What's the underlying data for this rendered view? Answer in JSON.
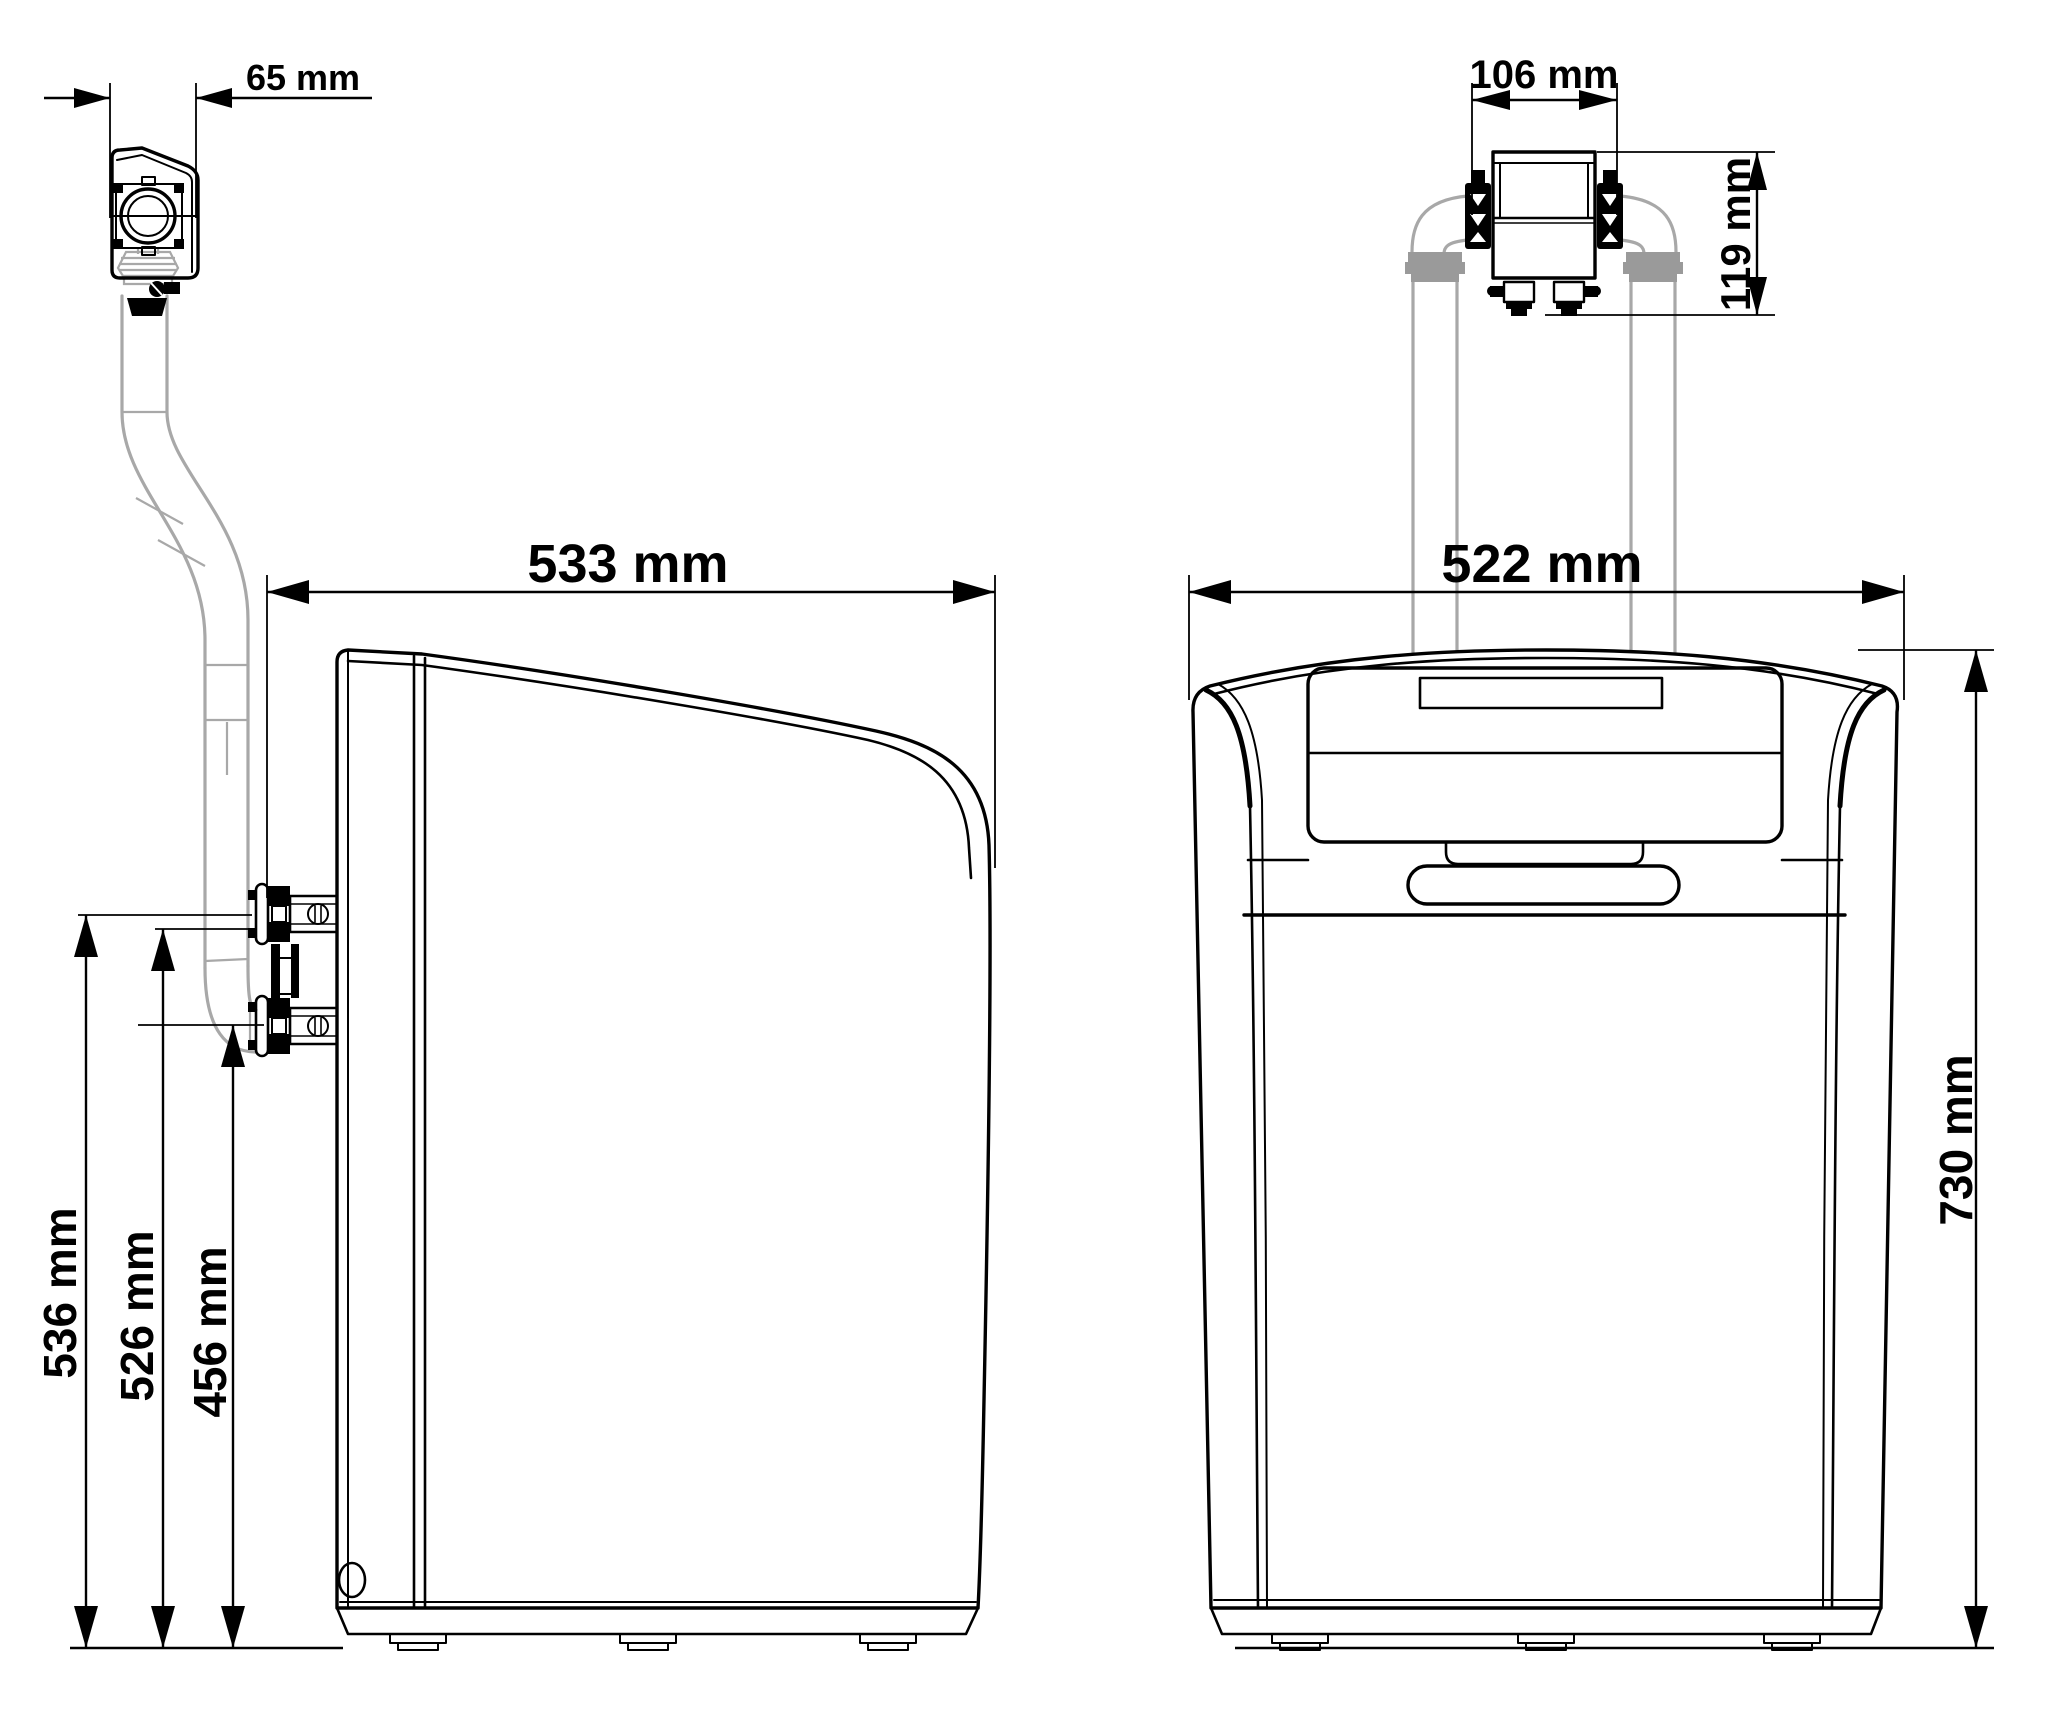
{
  "diagram": {
    "type": "technical-dimension-drawing",
    "subject": "water-softener-cabinet-two-views",
    "units": "mm",
    "views": [
      {
        "id": "side-view",
        "dimensions": [
          {
            "name": "drain-head-depth",
            "label": "65 mm"
          },
          {
            "name": "overall-depth",
            "label": "533 mm"
          },
          {
            "name": "upper-port-height",
            "label": "536 mm"
          },
          {
            "name": "lower-port-height",
            "label": "526 mm"
          },
          {
            "name": "drain-elbow-height",
            "label": "456 mm"
          }
        ]
      },
      {
        "id": "front-view",
        "dimensions": [
          {
            "name": "bypass-valve-width",
            "label": "106 mm"
          },
          {
            "name": "bypass-valve-height",
            "label": "119 mm"
          },
          {
            "name": "overall-width",
            "label": "522 mm"
          },
          {
            "name": "overall-height",
            "label": "730 mm"
          }
        ]
      }
    ],
    "colors": {
      "line": "#000000",
      "pipe_gray": "#a8a8a8",
      "fitting_gray": "#9a9a9a",
      "background": "#ffffff"
    }
  }
}
